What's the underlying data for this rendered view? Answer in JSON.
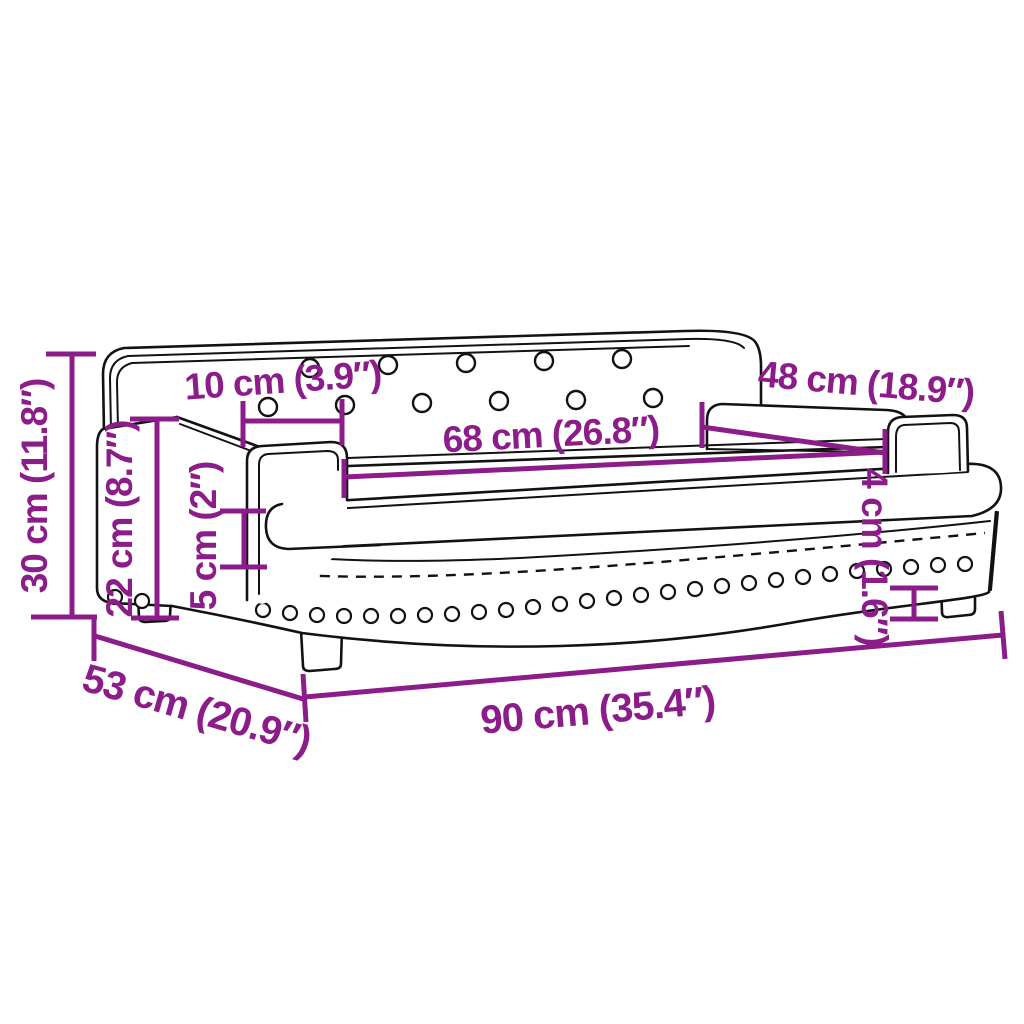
{
  "diagram": {
    "title": "Sofa dimension diagram",
    "colors": {
      "dimension": "#8C1C89",
      "outline": "#121212",
      "background": "#FFFFFF"
    },
    "dimensions": {
      "total_height": {
        "label": "30 cm (11.8″)",
        "cm": 30,
        "inch": 11.8
      },
      "armrest_height": {
        "label": "22 cm (8.7″)",
        "cm": 22,
        "inch": 8.7
      },
      "button_spacing": {
        "label": "10 cm (3.9″)",
        "cm": 10,
        "inch": 3.9
      },
      "seat_width": {
        "label": "68 cm (26.8″)",
        "cm": 68,
        "inch": 26.8
      },
      "armrest_length": {
        "label": "48 cm (18.9″)",
        "cm": 48,
        "inch": 18.9
      },
      "cushion_thickness": {
        "label": "5 cm (2″)",
        "cm": 5,
        "inch": 2
      },
      "leg_height": {
        "label": "4 cm (1.6″)",
        "cm": 4,
        "inch": 1.6
      },
      "depth": {
        "label": "53 cm (20.9″)",
        "cm": 53,
        "inch": 20.9
      },
      "width": {
        "label": "90 cm (35.4″)",
        "cm": 90,
        "inch": 35.4
      }
    }
  }
}
